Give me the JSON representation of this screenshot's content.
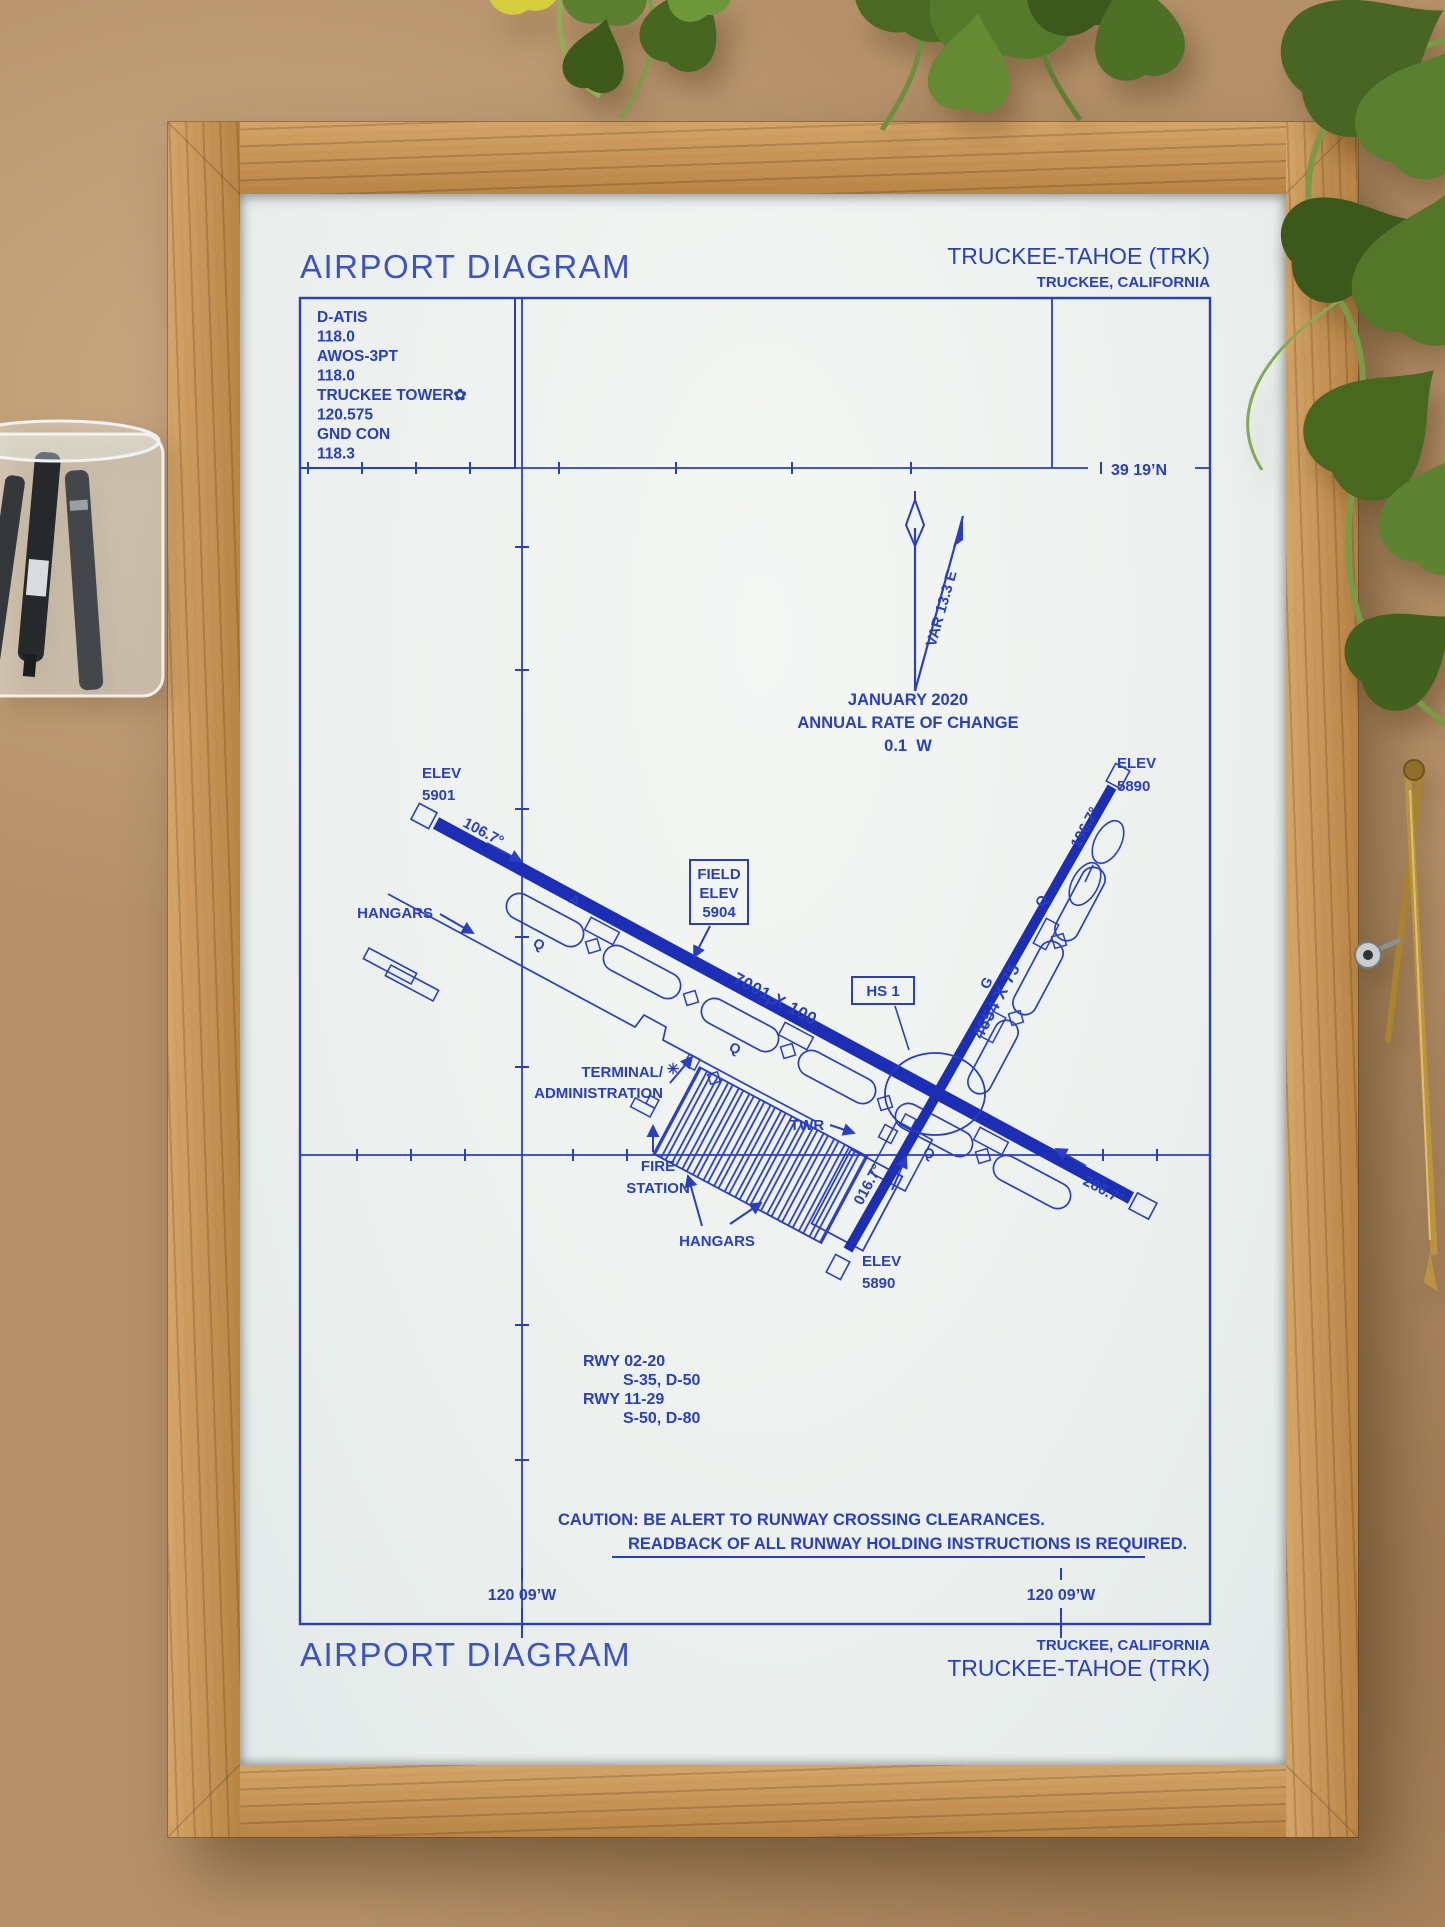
{
  "diagram": {
    "title": "AIRPORT DIAGRAM",
    "airport": "TRUCKEE-TAHOE (TRK)",
    "city": "TRUCKEE, CALIFORNIA",
    "comm": [
      "D-ATIS",
      "118.0",
      "AWOS-3PT",
      "118.0",
      "TRUCKEE TOWER✿",
      "120.575",
      "GND CON",
      "118.3"
    ],
    "north": {
      "variation": "VAR 13.3 E",
      "date": "JANUARY 2020",
      "rate": "ANNUAL RATE OF CHANGE",
      "value": "0.1  W"
    },
    "lat_label": "39 19’N",
    "lon_left": "120 09’W",
    "lon_right": "120 09’W",
    "field_elev": [
      "FIELD",
      "ELEV",
      "5904"
    ],
    "hotspot": "HS 1",
    "rwy1129": {
      "dim": "7001 X 100",
      "hdg_nw": "106.7°",
      "hdg_se": "286.7°"
    },
    "rwy0220": {
      "dim": "4654 X 75",
      "hdg_ne": "196.7°",
      "hdg_sw": "016.7°"
    },
    "elev_nw": [
      "ELEV",
      "5901"
    ],
    "elev_ne": [
      "ELEV",
      "5890"
    ],
    "elev_sw": [
      "ELEV",
      "5890"
    ],
    "labels": {
      "hangars_left": "HANGARS",
      "hangars_bottom": "HANGARS",
      "terminal1": "TERMINAL/",
      "terminal2": "ADMINISTRATION",
      "twr": "TWR",
      "fire1": "FIRE",
      "fire2": "STATION"
    },
    "beacon_symbol": "✳",
    "taxiway_letters": [
      "Q",
      "A",
      "Q",
      "F",
      "Q",
      "G",
      "Q"
    ],
    "rwy_info": [
      "RWY 02-20",
      "S-35, D-50",
      "RWY 11-29",
      "S-50, D-80"
    ],
    "caution1": "CAUTION: BE ALERT TO RUNWAY CROSSING CLEARANCES.",
    "caution2": "READBACK OF ALL RUNWAY HOLDING INSTRUCTIONS IS REQUIRED.",
    "footer": {
      "title": "AIRPORT DIAGRAM",
      "city": "TRUCKEE, CALIFORNIA",
      "airport": "TRUCKEE-TAHOE (TRK)"
    }
  },
  "colors": {
    "ink": "#2a3ec1",
    "runway": "#1c2eb5",
    "paper": "#edf1ef",
    "frame_wood": "#c49257",
    "background_cork": "#b5916a",
    "foliage": "#4e7026"
  }
}
